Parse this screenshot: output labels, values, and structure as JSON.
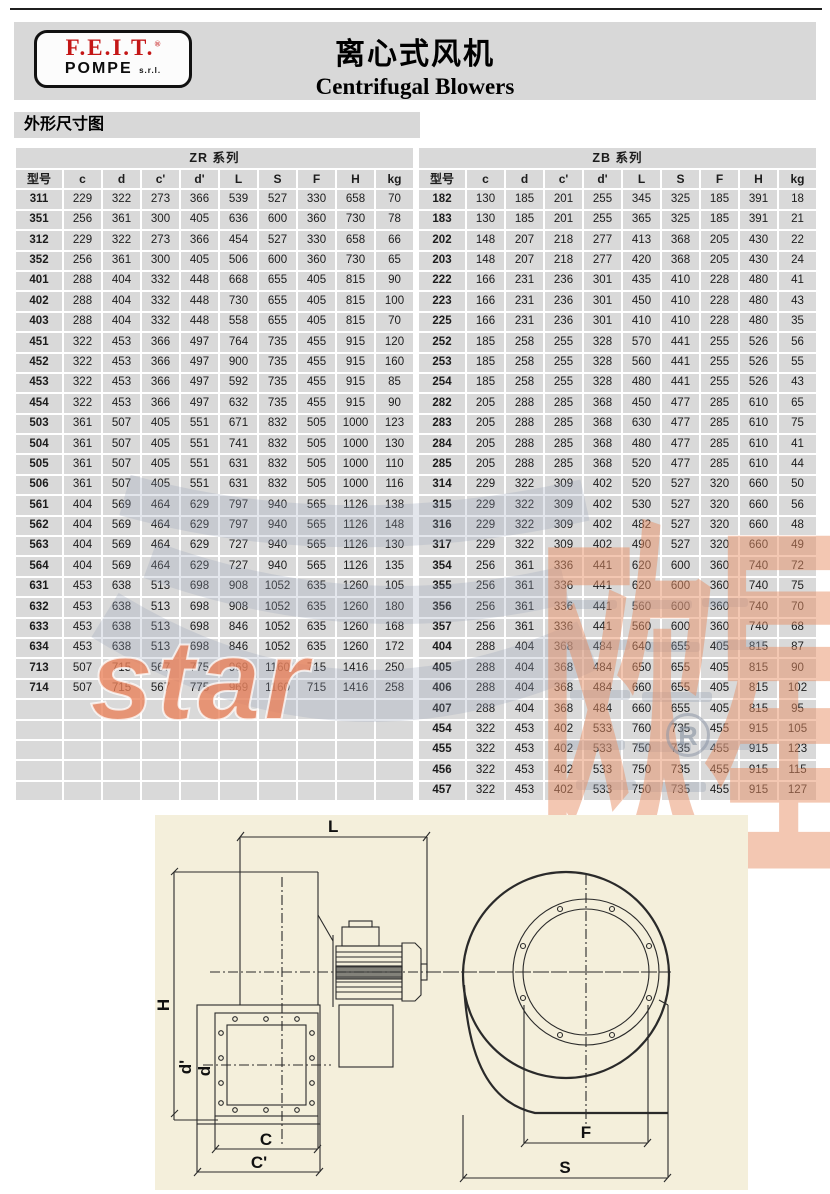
{
  "logo": {
    "brand": "F.E.I.T.",
    "reg": "®",
    "sub": "POMPE",
    "suffix": "s.r.l."
  },
  "header": {
    "title_cn": "离心式风机",
    "title_en": "Centrifugal Blowers"
  },
  "section_title": "外形尺寸图",
  "tables": {
    "zr": {
      "title": "ZR 系列",
      "columns": [
        "型号",
        "c",
        "d",
        "c'",
        "d'",
        "L",
        "S",
        "F",
        "H",
        "kg"
      ],
      "empty_rows": 5,
      "rows": [
        [
          "311",
          229,
          322,
          273,
          366,
          539,
          527,
          330,
          658,
          70
        ],
        [
          "351",
          256,
          361,
          300,
          405,
          636,
          600,
          360,
          730,
          78
        ],
        [
          "312",
          229,
          322,
          273,
          366,
          454,
          527,
          330,
          658,
          66
        ],
        [
          "352",
          256,
          361,
          300,
          405,
          506,
          600,
          360,
          730,
          65
        ],
        [
          "401",
          288,
          404,
          332,
          448,
          668,
          655,
          405,
          815,
          90
        ],
        [
          "402",
          288,
          404,
          332,
          448,
          730,
          655,
          405,
          815,
          100
        ],
        [
          "403",
          288,
          404,
          332,
          448,
          558,
          655,
          405,
          815,
          70
        ],
        [
          "451",
          322,
          453,
          366,
          497,
          764,
          735,
          455,
          915,
          120
        ],
        [
          "452",
          322,
          453,
          366,
          497,
          900,
          735,
          455,
          915,
          160
        ],
        [
          "453",
          322,
          453,
          366,
          497,
          592,
          735,
          455,
          915,
          85
        ],
        [
          "454",
          322,
          453,
          366,
          497,
          632,
          735,
          455,
          915,
          90
        ],
        [
          "503",
          361,
          507,
          405,
          551,
          671,
          832,
          505,
          1000,
          123
        ],
        [
          "504",
          361,
          507,
          405,
          551,
          741,
          832,
          505,
          1000,
          130
        ],
        [
          "505",
          361,
          507,
          405,
          551,
          631,
          832,
          505,
          1000,
          110
        ],
        [
          "506",
          361,
          507,
          405,
          551,
          631,
          832,
          505,
          1000,
          116
        ],
        [
          "561",
          404,
          569,
          464,
          629,
          797,
          940,
          565,
          1126,
          138
        ],
        [
          "562",
          404,
          569,
          464,
          629,
          797,
          940,
          565,
          1126,
          148
        ],
        [
          "563",
          404,
          569,
          464,
          629,
          727,
          940,
          565,
          1126,
          130
        ],
        [
          "564",
          404,
          569,
          464,
          629,
          727,
          940,
          565,
          1126,
          135
        ],
        [
          "631",
          453,
          638,
          513,
          698,
          908,
          1052,
          635,
          1260,
          105
        ],
        [
          "632",
          453,
          638,
          513,
          698,
          908,
          1052,
          635,
          1260,
          180
        ],
        [
          "633",
          453,
          638,
          513,
          698,
          846,
          1052,
          635,
          1260,
          168
        ],
        [
          "634",
          453,
          638,
          513,
          698,
          846,
          1052,
          635,
          1260,
          172
        ],
        [
          "713",
          507,
          715,
          567,
          775,
          969,
          1160,
          715,
          1416,
          250
        ],
        [
          "714",
          507,
          715,
          567,
          775,
          969,
          1160,
          715,
          1416,
          258
        ]
      ]
    },
    "zb": {
      "title": "ZB 系列",
      "columns": [
        "型号",
        "c",
        "d",
        "c'",
        "d'",
        "L",
        "S",
        "F",
        "H",
        "kg"
      ],
      "empty_rows": 0,
      "rows": [
        [
          "182",
          130,
          185,
          201,
          255,
          345,
          325,
          185,
          391,
          18
        ],
        [
          "183",
          130,
          185,
          201,
          255,
          365,
          325,
          185,
          391,
          21
        ],
        [
          "202",
          148,
          207,
          218,
          277,
          413,
          368,
          205,
          430,
          22
        ],
        [
          "203",
          148,
          207,
          218,
          277,
          420,
          368,
          205,
          430,
          24
        ],
        [
          "222",
          166,
          231,
          236,
          301,
          435,
          410,
          228,
          480,
          41
        ],
        [
          "223",
          166,
          231,
          236,
          301,
          450,
          410,
          228,
          480,
          43
        ],
        [
          "225",
          166,
          231,
          236,
          301,
          410,
          410,
          228,
          480,
          35
        ],
        [
          "252",
          185,
          258,
          255,
          328,
          570,
          441,
          255,
          526,
          56
        ],
        [
          "253",
          185,
          258,
          255,
          328,
          560,
          441,
          255,
          526,
          55
        ],
        [
          "254",
          185,
          258,
          255,
          328,
          480,
          441,
          255,
          526,
          43
        ],
        [
          "282",
          205,
          288,
          285,
          368,
          450,
          477,
          285,
          610,
          65
        ],
        [
          "283",
          205,
          288,
          285,
          368,
          630,
          477,
          285,
          610,
          75
        ],
        [
          "284",
          205,
          288,
          285,
          368,
          480,
          477,
          285,
          610,
          41
        ],
        [
          "285",
          205,
          288,
          285,
          368,
          520,
          477,
          285,
          610,
          44
        ],
        [
          "314",
          229,
          322,
          309,
          402,
          520,
          527,
          320,
          660,
          50
        ],
        [
          "315",
          229,
          322,
          309,
          402,
          530,
          527,
          320,
          660,
          56
        ],
        [
          "316",
          229,
          322,
          309,
          402,
          482,
          527,
          320,
          660,
          48
        ],
        [
          "317",
          229,
          322,
          309,
          402,
          490,
          527,
          320,
          660,
          49
        ],
        [
          "354",
          256,
          361,
          336,
          441,
          620,
          600,
          360,
          740,
          72
        ],
        [
          "355",
          256,
          361,
          336,
          441,
          620,
          600,
          360,
          740,
          75
        ],
        [
          "356",
          256,
          361,
          336,
          441,
          560,
          600,
          360,
          740,
          70
        ],
        [
          "357",
          256,
          361,
          336,
          441,
          560,
          600,
          360,
          740,
          68
        ],
        [
          "404",
          288,
          404,
          368,
          484,
          640,
          655,
          405,
          815,
          87
        ],
        [
          "405",
          288,
          404,
          368,
          484,
          650,
          655,
          405,
          815,
          90
        ],
        [
          "406",
          288,
          404,
          368,
          484,
          660,
          655,
          405,
          815,
          102
        ],
        [
          "407",
          288,
          404,
          368,
          484,
          660,
          655,
          405,
          815,
          95
        ],
        [
          "454",
          322,
          453,
          402,
          533,
          760,
          735,
          455,
          915,
          105
        ],
        [
          "455",
          322,
          453,
          402,
          533,
          750,
          735,
          455,
          915,
          123
        ],
        [
          "456",
          322,
          453,
          402,
          533,
          750,
          735,
          455,
          915,
          115
        ],
        [
          "457",
          322,
          453,
          402,
          533,
          750,
          735,
          455,
          915,
          127
        ]
      ]
    }
  },
  "watermark": {
    "text_cn": "欧星",
    "text_en": "star",
    "reg": "R",
    "orange": "#e79065",
    "gray": "#9ba5b9"
  },
  "diagram": {
    "labels": {
      "L": "L",
      "H": "H",
      "d_prime": "d'",
      "d": "d",
      "C": "C",
      "C_prime": "C'",
      "F": "F",
      "S": "S"
    }
  },
  "colors": {
    "band_bg": "#d8d8d8",
    "table_cell_bg": "#d9d9d9",
    "diagram_bg": "#f4efdb",
    "logo_red": "#c41616"
  }
}
